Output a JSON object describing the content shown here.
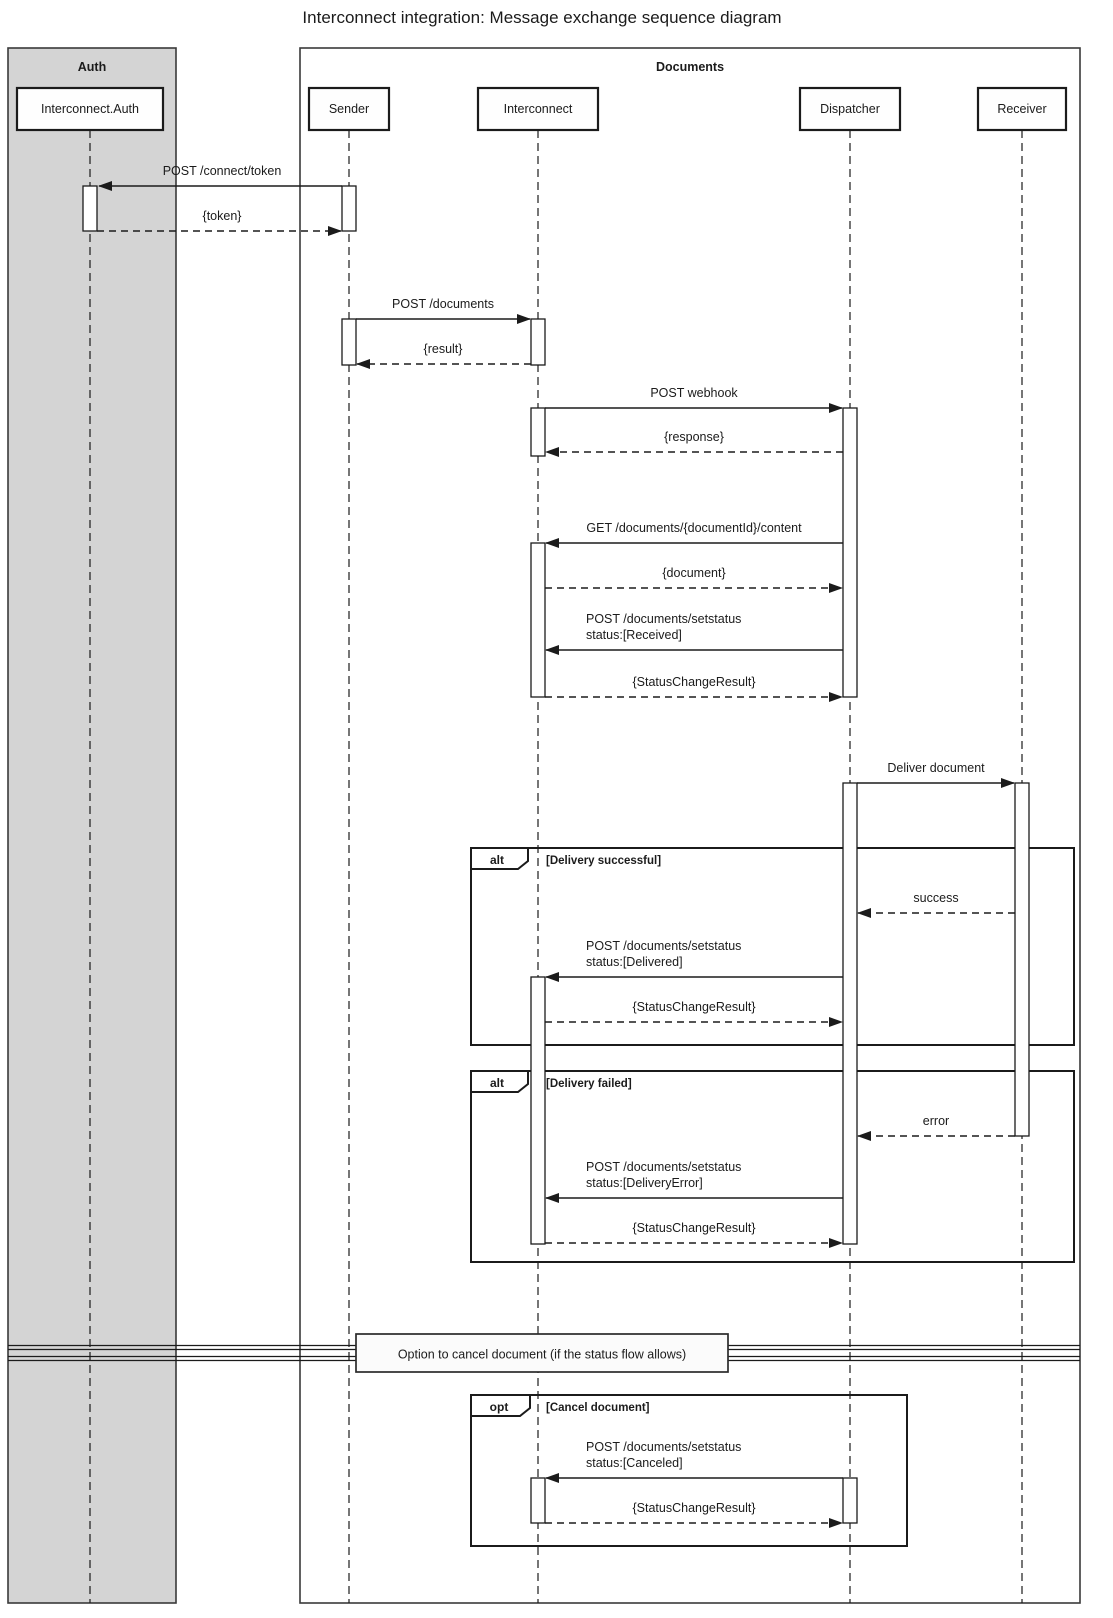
{
  "title": "Interconnect integration: Message exchange sequence diagram",
  "colors": {
    "auth_container_fill": "#d4d4d4",
    "documents_container_fill": "#ffffff",
    "line": "#1b1b1b",
    "background": "#ffffff"
  },
  "containers": {
    "auth": {
      "label": "Auth"
    },
    "documents": {
      "label": "Documents"
    }
  },
  "participants": {
    "interconnect_auth": {
      "label": "Interconnect.Auth"
    },
    "sender": {
      "label": "Sender"
    },
    "interconnect": {
      "label": "Interconnect"
    },
    "dispatcher": {
      "label": "Dispatcher"
    },
    "receiver": {
      "label": "Receiver"
    }
  },
  "messages": {
    "post_connect_token": {
      "label": "POST /connect/token",
      "from": "Sender",
      "to": "Interconnect.Auth",
      "style": "solid"
    },
    "token_reply": {
      "label": "{token}",
      "from": "Interconnect.Auth",
      "to": "Sender",
      "style": "dashed"
    },
    "post_documents": {
      "label": "POST /documents",
      "from": "Sender",
      "to": "Interconnect",
      "style": "solid"
    },
    "result_reply": {
      "label": "{result}",
      "from": "Interconnect",
      "to": "Sender",
      "style": "dashed"
    },
    "post_webhook": {
      "label": "POST webhook",
      "from": "Interconnect",
      "to": "Dispatcher",
      "style": "solid"
    },
    "response_reply": {
      "label": "{response}",
      "from": "Dispatcher",
      "to": "Interconnect",
      "style": "dashed"
    },
    "get_document_content": {
      "label": "GET /documents/{documentId}/content",
      "from": "Dispatcher",
      "to": "Interconnect",
      "style": "solid"
    },
    "document_reply": {
      "label": "{document}",
      "from": "Interconnect",
      "to": "Dispatcher",
      "style": "dashed"
    },
    "set_status_received": {
      "line1": "POST /documents/setstatus",
      "line2": "status:[Received]",
      "from": "Dispatcher",
      "to": "Interconnect",
      "style": "solid"
    },
    "status_change_result_1": {
      "label": "{StatusChangeResult}",
      "from": "Interconnect",
      "to": "Dispatcher",
      "style": "dashed"
    },
    "deliver_document": {
      "label": "Deliver document",
      "from": "Dispatcher",
      "to": "Receiver",
      "style": "solid"
    },
    "success_reply": {
      "label": "success",
      "from": "Receiver",
      "to": "Dispatcher",
      "style": "dashed"
    },
    "set_status_delivered": {
      "line1": "POST /documents/setstatus",
      "line2": "status:[Delivered]",
      "from": "Dispatcher",
      "to": "Interconnect",
      "style": "solid"
    },
    "status_change_result_2": {
      "label": "{StatusChangeResult}",
      "from": "Interconnect",
      "to": "Dispatcher",
      "style": "dashed"
    },
    "error_reply": {
      "label": "error",
      "from": "Receiver",
      "to": "Dispatcher",
      "style": "dashed"
    },
    "set_status_delivery_error": {
      "line1": "POST /documents/setstatus",
      "line2": "status:[DeliveryError]",
      "from": "Dispatcher",
      "to": "Interconnect",
      "style": "solid"
    },
    "status_change_result_3": {
      "label": "{StatusChangeResult}",
      "from": "Interconnect",
      "to": "Dispatcher",
      "style": "dashed"
    },
    "set_status_canceled": {
      "line1": "POST /documents/setstatus",
      "line2": "status:[Canceled]",
      "from": "Dispatcher",
      "to": "Interconnect",
      "style": "solid"
    },
    "status_change_result_4": {
      "label": "{StatusChangeResult}",
      "from": "Interconnect",
      "to": "Dispatcher",
      "style": "dashed"
    }
  },
  "frames": {
    "alt_delivery_successful": {
      "operator": "alt",
      "guard": "[Delivery successful]"
    },
    "alt_delivery_failed": {
      "operator": "alt",
      "guard": "[Delivery failed]"
    },
    "opt_cancel_document": {
      "operator": "opt",
      "guard": "[Cancel document]"
    }
  },
  "divider": {
    "label": "Option to cancel document (if the status flow allows)"
  }
}
